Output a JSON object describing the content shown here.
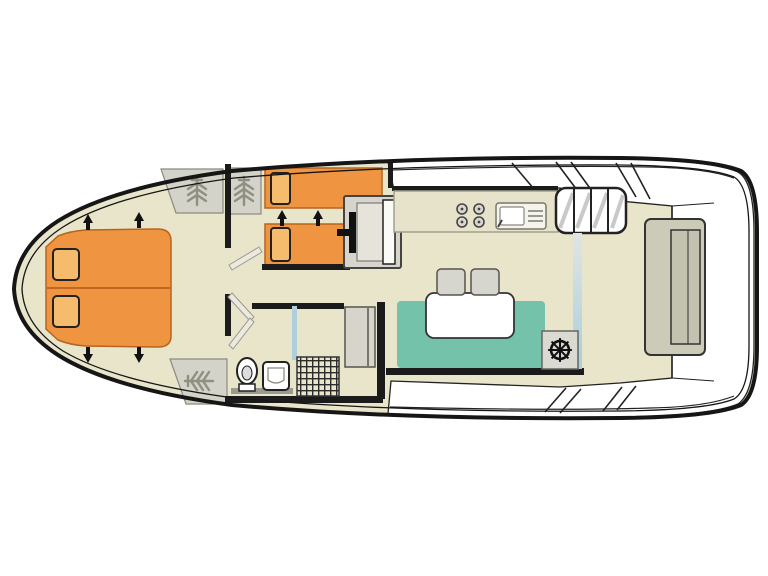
{
  "meta": {
    "title": "Boat deck floor plan",
    "diagram_type": "floor-plan",
    "orientation": "bow-left-stern-right"
  },
  "colors": {
    "background": "#ffffff",
    "hull_line": "#161616",
    "floor": "#e9e5cb",
    "deck_white": "#ffffff",
    "wall": "#1b1b1b",
    "bed_orange": "#ef9440",
    "pillow_orange": "#f5bc6e",
    "bed_edge": "#b5651d",
    "sofa_teal": "#74c2aa",
    "table_white": "#ffffff",
    "stool_gray": "#d7d6ce",
    "wardrobe_gray": "#d4d3c9",
    "wardrobe_icon_gray": "#8f8f82",
    "door_gray": "#d6d4cb",
    "door_inner": "#e6e4da",
    "counter": "#e7e3cb",
    "steps_white": "#ffffff",
    "glass_blue": "#aecfdb",
    "bench_gray": "#cbcbb8",
    "bench_inner": "#c2c2ae",
    "helm_gray": "#dad9d2",
    "fixture_white": "#ffffff",
    "vanity_gray": "#9a9a90",
    "arrow_black": "#111111"
  },
  "rooms": [
    {
      "id": "bow-cabin"
    },
    {
      "id": "twin-cabin"
    },
    {
      "id": "corridor"
    },
    {
      "id": "bathroom"
    },
    {
      "id": "galley"
    },
    {
      "id": "saloon"
    },
    {
      "id": "aft-deck"
    }
  ],
  "icons": [
    {
      "name": "double-bed",
      "count": 1
    },
    {
      "name": "single-bed",
      "count": 2
    },
    {
      "name": "pillow",
      "count": 4
    },
    {
      "name": "hatch-arrow-icon",
      "count": 6
    },
    {
      "name": "wardrobe-hanger-icon",
      "count": 3
    },
    {
      "name": "door-swing",
      "count": 3
    },
    {
      "name": "cabin-door-panel",
      "count": 2
    },
    {
      "name": "toilet-icon",
      "count": 1
    },
    {
      "name": "washbasin-icon",
      "count": 1
    },
    {
      "name": "shower-grid-icon",
      "count": 1
    },
    {
      "name": "stove-burners-icon",
      "count": 1
    },
    {
      "name": "galley-sink-icon",
      "count": 1
    },
    {
      "name": "companionway-steps",
      "count": 1
    },
    {
      "name": "dinette-table",
      "count": 1
    },
    {
      "name": "stool",
      "count": 2
    },
    {
      "name": "helm-wheel-icon",
      "count": 1
    },
    {
      "name": "stern-bench",
      "count": 1
    },
    {
      "name": "side-deck-steps",
      "count": 2
    }
  ]
}
